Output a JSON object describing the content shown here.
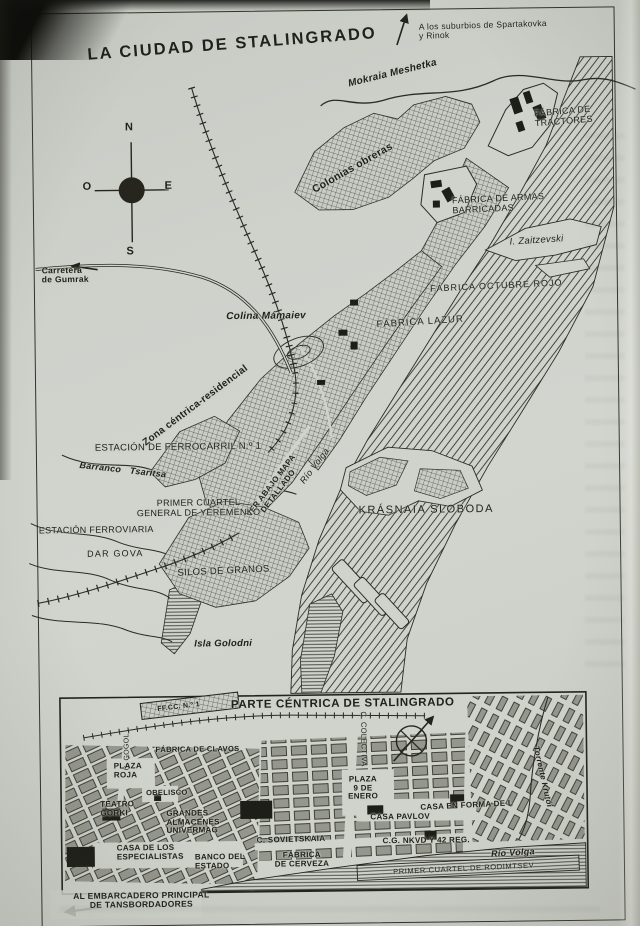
{
  "page": {
    "title": "LA CIUDAD DE STALINGRADO",
    "inset_title": "PARTE CÉNTRICA DE STALINGRADO"
  },
  "compass": {
    "n": "N",
    "s": "S",
    "e": "E",
    "o": "O"
  },
  "colors": {
    "paper": "#cfd3cc",
    "ink": "#23231d"
  },
  "main_map": {
    "suburbs_note": "A los suburbios de Spartakovka\ny Rinok",
    "river_mokraia": "Mokraia Meshetka",
    "colonias_obreras": "Colonias obreras",
    "fabrica_tractores": "FÁBRICA DE\nTRACTORES",
    "fabrica_armas": "FÁBRICA DE ARMAS\nBARRICADAS",
    "isla_zaitzevski": "I. Zaitzevski",
    "fabrica_octubre": "FÁBRICA OCTUBRE ROJO",
    "fabrica_lazur": "FÁBRICA LAZUR",
    "colina_mamaiev": "Colina Mámaiev",
    "carretera_gumrak": "Carretera\nde Gumrak",
    "zona_centrica": "Zona céntrica-residencial",
    "estacion_ferrocarril": "ESTACIÓN DE FERROCARRIL N.º 1",
    "barranco_tsaritsa": "Barranco   Tsaritsa",
    "ver_abajo_mapa": "VER ABAJO MAPA\nDETALLADO",
    "rio_volga": "Río Volga",
    "primer_cuartel_yeremenko": "PRIMER CUARTEL\nGENERAL DE YEREMENKO",
    "estacion_ferroviaria": "ESTACIÓN FERROVIARIA",
    "dar_gova": "DAR GOVA",
    "silos_granos": "SILOS DE GRANOS",
    "krasnaia_sloboda": "KRÁSNAIA SLOBODA",
    "isla_golodni": "Isla Golodni"
  },
  "inset_map": {
    "ffcc_n1": "FF.CC. N.º 1",
    "c_gogol": "C. GOGOL",
    "fabrica_clavos": "FÁBRICA DE CLAVOS",
    "c_colectiva": "C. COLECTIVA",
    "plaza_roja": "PLAZA\nROJA",
    "obelisco": "OBELISCO",
    "teatro_gorki": "TEATRO\nGORKI",
    "grandes_almacenes": "GRANDES\nALMACENES\nUNIVERMAG",
    "casa_especialistas": "CASA DE LOS\nESPECIALISTAS",
    "banco_estado": "BANCO DEL\nESTADO",
    "c_sovietskaia": "C. SOVIETSKAIA",
    "plaza_9_enero": "PLAZA\n9 DE\nENERO",
    "casa_pavlov": "CASA PAVLOV",
    "casa_forma_l": "CASA EN FORMA DE L",
    "cg_nkvd": "C.G. NKVD Y 42 REG.",
    "torrente_krutoi": "Torrente Krutói",
    "fabrica_cerveza": "FÁBRICA\nDE CERVEZA",
    "primer_cuartel_rodimtsev": "PRIMER CUARTEL DE RODIMTSEV",
    "rio_volga": "Río Volga",
    "al_embarcadero": "AL EMBARCADERO PRINCIPAL\nDE TANSBORDADORES"
  }
}
